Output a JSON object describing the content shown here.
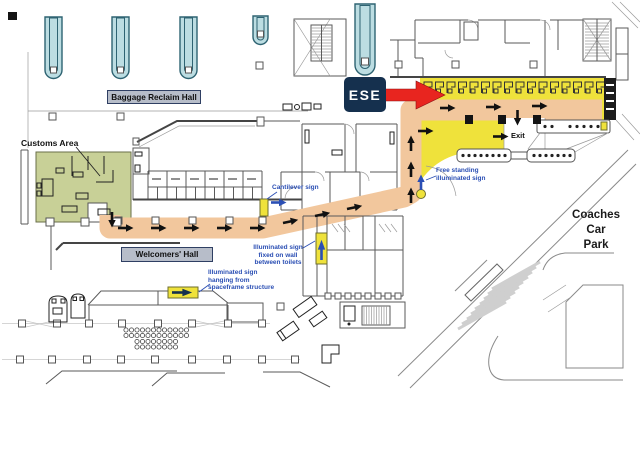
{
  "colors": {
    "route_orange": "#f2c79d",
    "highlight_yellow": "#efe23b",
    "customs_green": "#c8d097",
    "carousel_blue": "#bcdde2",
    "label_box_bg": "#b7bdc9",
    "label_box_border": "#2f3f63",
    "navy": "#15304e",
    "arrow_red": "#e8251f",
    "annotation_blue": "#2b4fb4"
  },
  "plan": {
    "halls": {
      "baggage_reclaim": "Baggage Reclaim Hall",
      "welcomers": "Welcomers' Hall",
      "customs": "Customs Area",
      "exit": "Exit",
      "coaches_car_park": [
        "Coaches",
        "Car",
        "Park"
      ]
    },
    "ese_badge": "ESE",
    "sign_annotations": {
      "cantilever": [
        "Cantilever sign"
      ],
      "free_standing": [
        "Free standing",
        "illuminated sign"
      ],
      "fixed_on_wall": [
        "Illuminated sign",
        "fixed on wall",
        "between toilets"
      ],
      "hanging": [
        "Illuminated sign",
        "hanging from",
        "spaceframe structure"
      ]
    }
  }
}
